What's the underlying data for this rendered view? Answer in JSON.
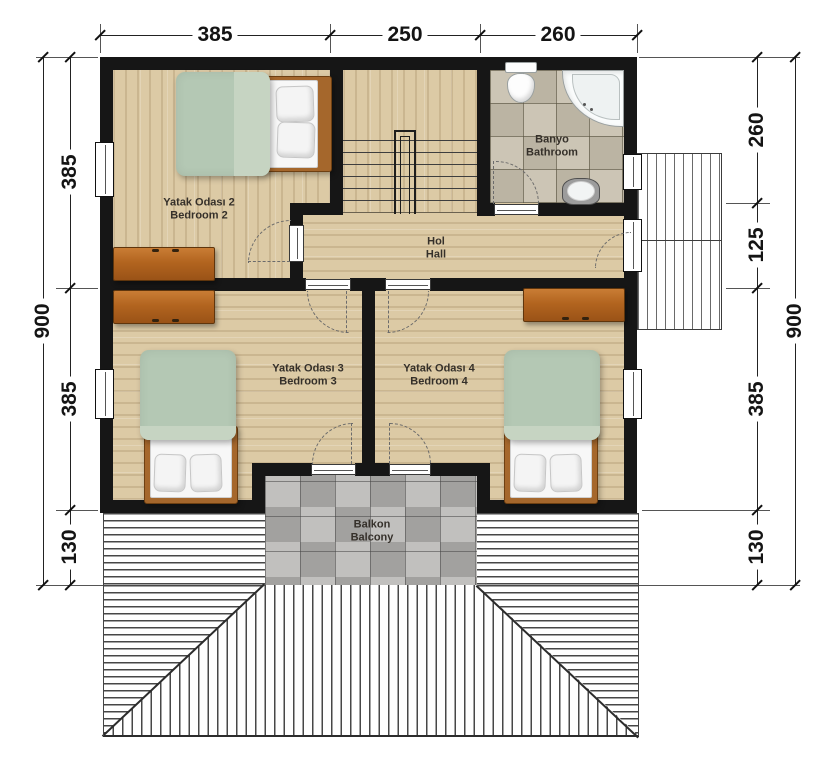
{
  "dimensions": {
    "top": [
      "385",
      "250",
      "260"
    ],
    "left": {
      "overall": "900",
      "segments": [
        "385",
        "385",
        "130"
      ]
    },
    "right": {
      "overall": "900",
      "segments": [
        "260",
        "125",
        "385",
        "130"
      ]
    }
  },
  "rooms": {
    "bedroom2": {
      "tr": "Yatak Odası 2",
      "en": "Bedroom 2"
    },
    "hall": {
      "tr": "Hol",
      "en": "Hall"
    },
    "bathroom": {
      "tr": "Banyo",
      "en": "Bathroom"
    },
    "bedroom3": {
      "tr": "Yatak Odası 3",
      "en": "Bedroom 3"
    },
    "bedroom4": {
      "tr": "Yatak Odası 4",
      "en": "Bedroom 4"
    },
    "balcony": {
      "tr": "Balkon",
      "en": "Balcony"
    }
  },
  "elements": {
    "bed": "double-bed",
    "dresser": "dresser",
    "toilet": "toilet",
    "bathtub": "corner-bathtub",
    "sink": "sink",
    "stairs": "staircase",
    "deck": "side-deck",
    "roof": "hip-roof-hatching"
  },
  "colors": {
    "wall": "#161616",
    "wood_floor": "#dccaa5",
    "bath_tile": "#ccc5b5",
    "balcony_tile": "#c1c0be",
    "dresser": "#b2641f",
    "duvet": "#b4c8b4",
    "bed_frame": "#a5672c"
  }
}
